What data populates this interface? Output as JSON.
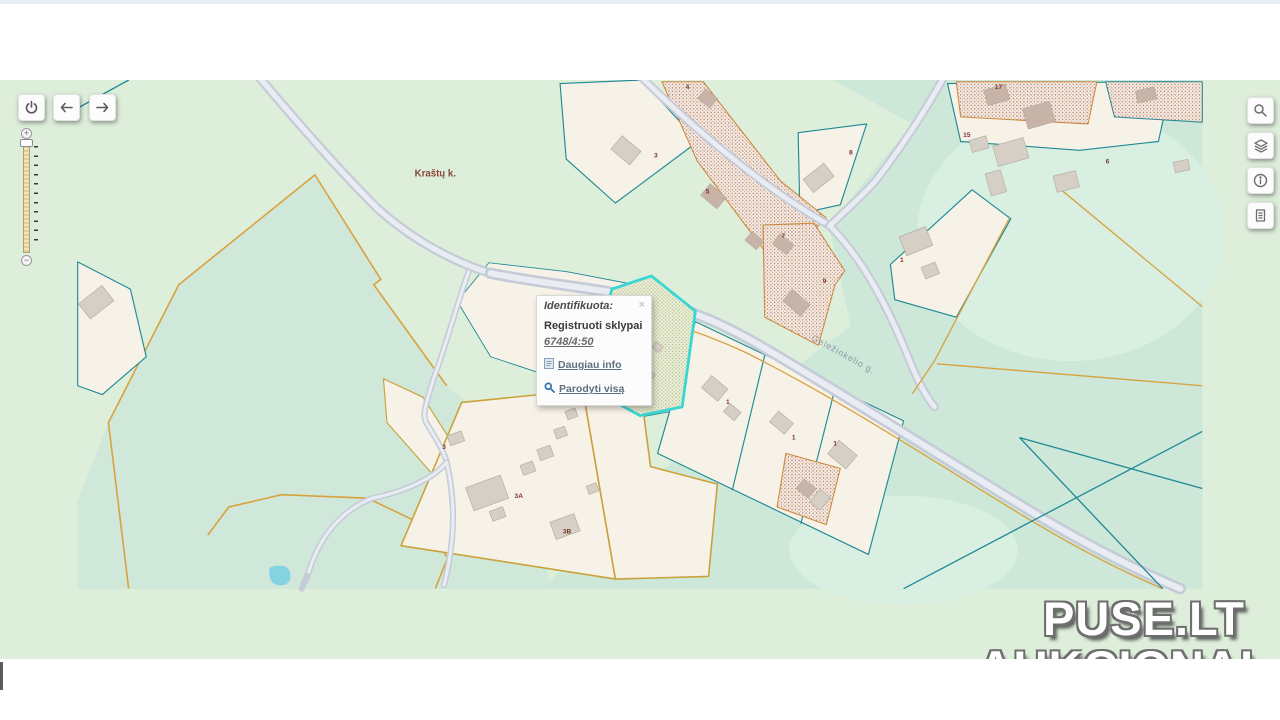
{
  "map": {
    "region_label": "Kraštų k.",
    "street_label": "Geležinkelio g.",
    "parcel_labels": [
      {
        "text": "4"
      },
      {
        "text": "3"
      },
      {
        "text": "5"
      },
      {
        "text": "7"
      },
      {
        "text": "9"
      },
      {
        "text": "17"
      },
      {
        "text": "15"
      },
      {
        "text": "8"
      },
      {
        "text": "1"
      },
      {
        "text": "6"
      },
      {
        "text": "1"
      },
      {
        "text": "1"
      },
      {
        "text": "1"
      },
      {
        "text": "3"
      },
      {
        "text": "3A"
      },
      {
        "text": "3B"
      }
    ],
    "colors": {
      "background_green": "#ddeeda",
      "mint_green": "#cde7d8",
      "parcel_fill": "#f7f2e8",
      "parcel_border_teal": "#1f8a95",
      "boundary_orange": "#d9a13d",
      "highlight_cyan": "#3ad6d4",
      "road_fill": "#e9ecf2",
      "road_casing": "#c5cbd7",
      "water_blue": "#85d2e3"
    }
  },
  "popup": {
    "title": "Identifikuota:",
    "close_label": "×",
    "section_title": "Registruoti sklypai",
    "parcel_code": "6748/4:50",
    "link_more": "Daugiau info",
    "link_show": "Parodyti visą"
  },
  "controls": {
    "nav": [
      {
        "icon": "power-icon"
      },
      {
        "icon": "arrow-left-icon"
      },
      {
        "icon": "arrow-right-icon"
      }
    ],
    "zoom_slider": {
      "zoom_in": "+",
      "zoom_out": "−"
    },
    "toolbar": [
      {
        "icon": "search-icon"
      },
      {
        "icon": "layers-icon"
      },
      {
        "icon": "info-icon"
      },
      {
        "icon": "document-icon"
      }
    ]
  },
  "watermark": {
    "line1": "PUSE.LT",
    "line2": "AUKCIONAI"
  }
}
